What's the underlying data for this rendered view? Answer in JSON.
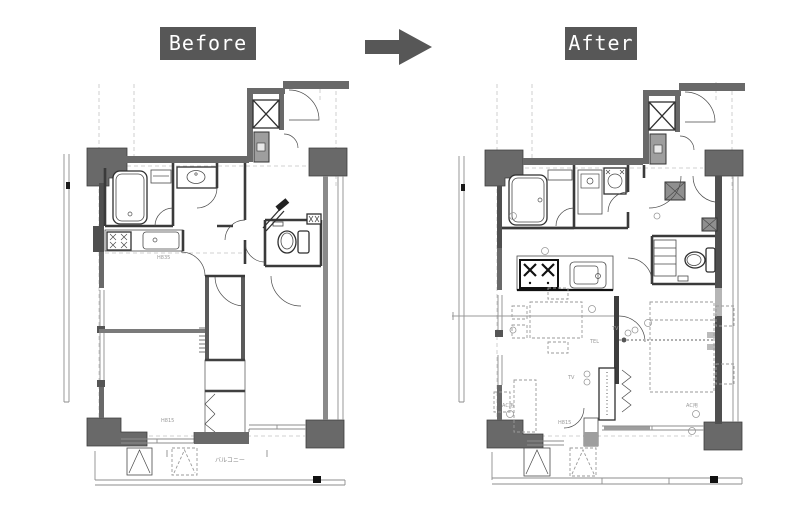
{
  "header": {
    "before_label": "Before",
    "after_label": "After",
    "label_bg": "#575757",
    "label_text_color": "#ffffff",
    "arrow_color": "#575757"
  },
  "colors": {
    "wall": "#696969",
    "wall_dark": "#4f4f4f",
    "line": "#2f2f2f",
    "line_gray": "#8d8d8d",
    "dashed_grid": "#c4c4c4",
    "meter_box": "#9e9e9e",
    "background": "#ffffff"
  },
  "plans": {
    "before": {
      "name": "Before floor plan",
      "labels": {
        "balcony": "バルコニー",
        "counter_height": "H835",
        "window_height": "H815"
      }
    },
    "after": {
      "name": "After floor plan",
      "labels": {
        "tel": "TEL",
        "tv1": "TV",
        "tv2": "TV",
        "living_ac": "AC用",
        "bedroom_ac": "AC用",
        "window_height": "H815"
      }
    }
  }
}
